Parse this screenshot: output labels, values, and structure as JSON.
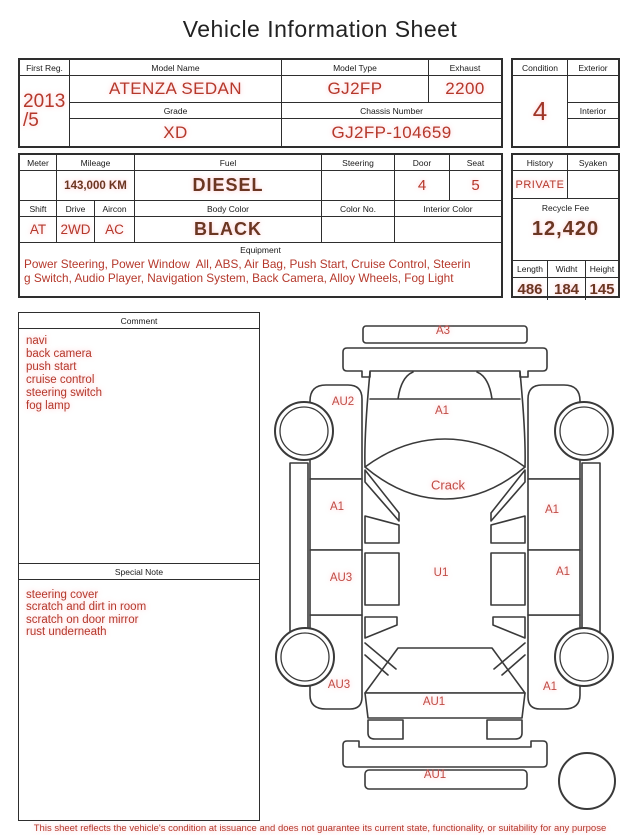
{
  "title": "Vehicle Information Sheet",
  "table1": {
    "first_reg": {
      "label": "First Reg.",
      "value_line1": "2013",
      "value_line2": "/5"
    },
    "model_name": {
      "label": "Model Name",
      "value": "ATENZA SEDAN"
    },
    "model_type": {
      "label": "Model Type",
      "value": "GJ2FP"
    },
    "exhaust": {
      "label": "Exhaust",
      "value": "2200"
    },
    "grade": {
      "label": "Grade",
      "value": "XD"
    },
    "chassis_number": {
      "label": "Chassis Number",
      "value": "GJ2FP-104659"
    },
    "condition": {
      "label": "Condition",
      "value": "4"
    },
    "exterior": {
      "label": "Exterior",
      "value": ""
    },
    "interior": {
      "label": "Interior",
      "value": ""
    }
  },
  "table2": {
    "meter": {
      "label": "Meter",
      "value": ""
    },
    "mileage": {
      "label": "Mileage",
      "value": "143,000 KM"
    },
    "fuel": {
      "label": "Fuel",
      "value": "DIESEL"
    },
    "steering": {
      "label": "Steering",
      "value": ""
    },
    "door": {
      "label": "Door",
      "value": "4"
    },
    "seat": {
      "label": "Seat",
      "value": "5"
    },
    "shift": {
      "label": "Shift",
      "value": "AT"
    },
    "drive": {
      "label": "Drive",
      "value": "2WD"
    },
    "aircon": {
      "label": "Aircon",
      "value": "AC"
    },
    "body_color": {
      "label": "Body Color",
      "value": "BLACK"
    },
    "color_no": {
      "label": "Color No.",
      "value": ""
    },
    "interior_color": {
      "label": "Interior Color",
      "value": ""
    },
    "history": {
      "label": "History",
      "value": "PRIVATE"
    },
    "syaken": {
      "label": "Syaken",
      "value": ""
    },
    "recycle_fee": {
      "label": "Recycle Fee",
      "value": "12,420"
    },
    "length": {
      "label": "Length",
      "value": "486"
    },
    "width": {
      "label": "Widht",
      "value": "184"
    },
    "height": {
      "label": "Height",
      "value": "145"
    },
    "equipment": {
      "label": "Equipment",
      "lines": [
        "Power Steering, Power Window  All, ABS, Air Bag, Push Start, Cruise Control, Steerin",
        "g Switch, Audio Player, Navigation System, Back Camera, Alloy Wheels, Fog Light"
      ]
    }
  },
  "comment": {
    "label": "Comment",
    "lines": [
      "navi",
      "back camera",
      "push start",
      "cruise control",
      "steering switch",
      "fog lamp"
    ]
  },
  "special_note": {
    "label": "Special Note",
    "lines": [
      "steering cover",
      "scratch and dirt in room",
      "scratch on door mirror",
      "rust underneath"
    ]
  },
  "diagram": {
    "markers": [
      {
        "label": "A3",
        "part": "front-bumper",
        "x": 443,
        "y": 331,
        "size": 11.5
      },
      {
        "label": "AU2",
        "part": "front-fender-left",
        "x": 343,
        "y": 402,
        "size": 11.5
      },
      {
        "label": "A1",
        "part": "hood",
        "x": 442,
        "y": 411,
        "size": 11.5
      },
      {
        "label": "Crack",
        "part": "windshield",
        "x": 448,
        "y": 485,
        "size": 13
      },
      {
        "label": "A1",
        "part": "front-door-left",
        "x": 337,
        "y": 507,
        "size": 11.5
      },
      {
        "label": "A1",
        "part": "front-door-right",
        "x": 552,
        "y": 510,
        "size": 11.5
      },
      {
        "label": "AU3",
        "part": "rear-door-left",
        "x": 341,
        "y": 578,
        "size": 11.5
      },
      {
        "label": "U1",
        "part": "roof",
        "x": 441,
        "y": 573,
        "size": 11.5
      },
      {
        "label": "A1",
        "part": "rear-door-right",
        "x": 563,
        "y": 572,
        "size": 11.5
      },
      {
        "label": "AU3",
        "part": "rear-fender-left",
        "x": 339,
        "y": 685,
        "size": 11.5
      },
      {
        "label": "A1",
        "part": "rear-fender-right",
        "x": 550,
        "y": 687,
        "size": 11.5
      },
      {
        "label": "AU1",
        "part": "trunk",
        "x": 434,
        "y": 702,
        "size": 11.5
      },
      {
        "label": "AU1",
        "part": "rear-bumper",
        "x": 435,
        "y": 775,
        "size": 11.5
      }
    ]
  },
  "footer": {
    "disclaimer": "This sheet reflects the vehicle's condition at issuance and does not guarantee its current state, functionality, or suitability for any purpose"
  },
  "colors": {
    "red_text": "#b5382b",
    "dark_red_text": "#6b3622",
    "marker_red": "#c14b44",
    "line": "#2e2e2e"
  }
}
